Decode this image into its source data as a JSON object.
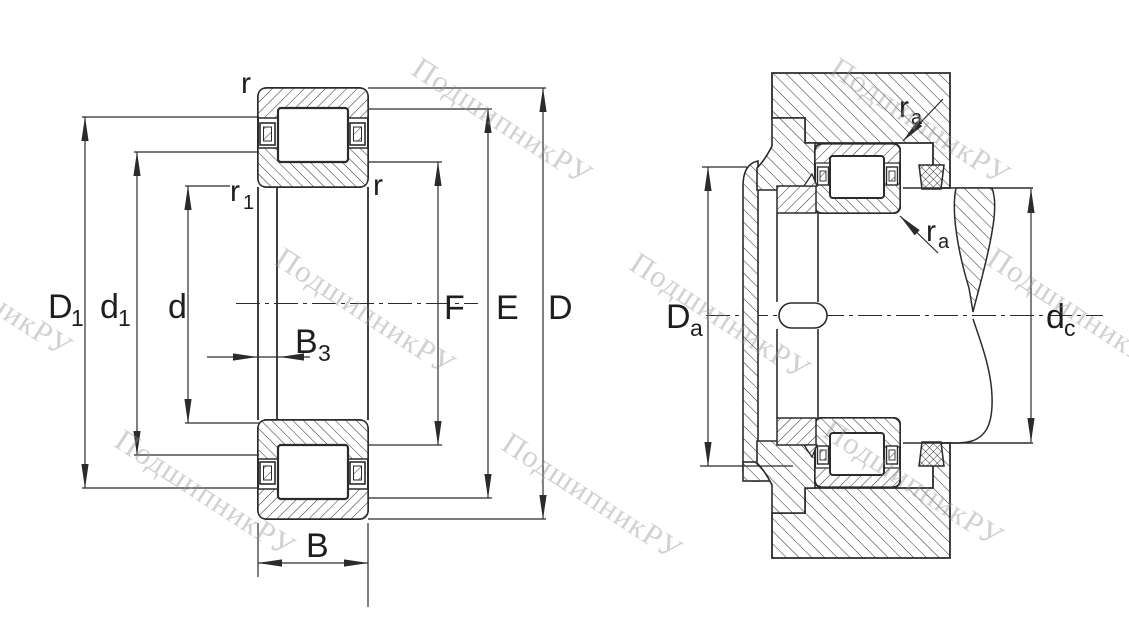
{
  "watermark_text": "ПодшипникРУ",
  "colors": {
    "line": "#2b2b2b",
    "background": "#ffffff",
    "watermark": "#c6c6c6"
  },
  "left_labels": {
    "r_outer": {
      "main": "r",
      "sub": ""
    },
    "r_inner_top": {
      "main": "r",
      "sub": "1"
    },
    "r_inner_right": {
      "main": "r",
      "sub": ""
    },
    "D1": {
      "main": "D",
      "sub": "1"
    },
    "d1": {
      "main": "d",
      "sub": "1"
    },
    "d": {
      "main": "d",
      "sub": ""
    },
    "B3": {
      "main": "B",
      "sub": "3"
    },
    "B": {
      "main": "B",
      "sub": ""
    },
    "F": {
      "main": "F",
      "sub": ""
    },
    "E": {
      "main": "E",
      "sub": ""
    },
    "D": {
      "main": "D",
      "sub": ""
    }
  },
  "right_labels": {
    "ra_top": {
      "main": "r",
      "sub": "a"
    },
    "ra_bottom": {
      "main": "r",
      "sub": "a"
    },
    "Da": {
      "main": "D",
      "sub": "a"
    },
    "dc": {
      "main": "d",
      "sub": "c"
    }
  }
}
